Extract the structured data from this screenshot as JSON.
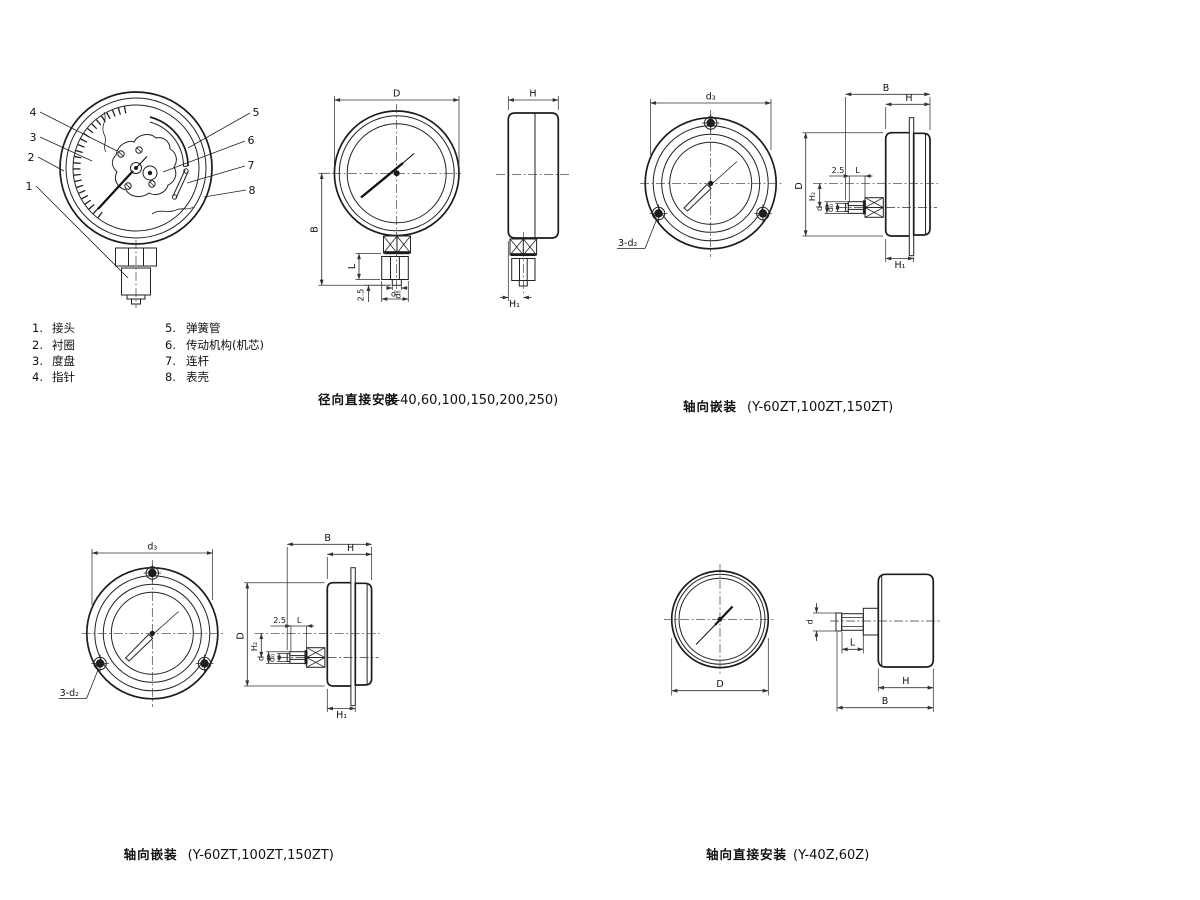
{
  "colors": {
    "ink": "#1c1c1c",
    "background": "#ffffff"
  },
  "cutaway": {
    "callouts": [
      "1",
      "2",
      "3",
      "4",
      "5",
      "6",
      "7",
      "8"
    ]
  },
  "legend": {
    "items": [
      {
        "num": "1.",
        "label": "接头"
      },
      {
        "num": "2.",
        "label": "衬圈"
      },
      {
        "num": "3.",
        "label": "度盘"
      },
      {
        "num": "4.",
        "label": "指针"
      },
      {
        "num": "5.",
        "label": "弹簧管"
      },
      {
        "num": "6.",
        "label": "传动机构(机芯)"
      },
      {
        "num": "7.",
        "label": "连杆"
      },
      {
        "num": "8.",
        "label": "表壳"
      }
    ]
  },
  "captions": {
    "radial": {
      "title": "径向直接安装",
      "models": "(Y-40,60,100,150,200,250)"
    },
    "axial_embedded": {
      "title": "轴向嵌装",
      "models": "(Y-60ZT,100ZT,150ZT)"
    },
    "axial_direct": {
      "title": "轴向直接安装",
      "models": "(Y-40Z,60Z)"
    }
  },
  "dims": {
    "D": "D",
    "H": "H",
    "B": "B",
    "L": "L",
    "offset25": "2.5",
    "d": "d",
    "d0": "d₀",
    "H1": "H₁",
    "H2": "H₂",
    "d3": "d₃",
    "holes": "3-d₂"
  }
}
